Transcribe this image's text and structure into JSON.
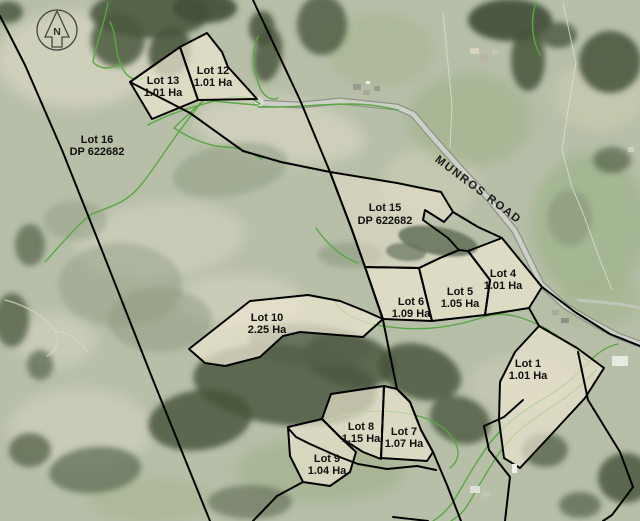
{
  "compass": {
    "label": "N"
  },
  "road": {
    "label": "MUNROS ROAD"
  },
  "lots": [
    {
      "name": "Lot 13",
      "sublabel": "1.01 Ha"
    },
    {
      "name": "Lot 12",
      "sublabel": "1.01 Ha"
    },
    {
      "name": "Lot 16",
      "sublabel": "DP 622682"
    },
    {
      "name": "Lot 15",
      "sublabel": "DP 622682"
    },
    {
      "name": "Lot 4",
      "sublabel": "1.01 Ha"
    },
    {
      "name": "Lot 5",
      "sublabel": "1.05 Ha"
    },
    {
      "name": "Lot 6",
      "sublabel": "1.09 Ha"
    },
    {
      "name": "Lot 1",
      "sublabel": "1.01 Ha"
    },
    {
      "name": "Lot 10",
      "sublabel": "2.25 Ha"
    },
    {
      "name": "Lot 8",
      "sublabel": "1.15 Ha"
    },
    {
      "name": "Lot 7",
      "sublabel": "1.07 Ha"
    },
    {
      "name": "Lot 9",
      "sublabel": "1.04 Ha"
    }
  ],
  "colors": {
    "boundary": "#000000",
    "green_line": "#58a843",
    "lot_fill": "#ebe4cf",
    "road_fill": "#cdd0c7",
    "road_casing": "#8e948a",
    "label_text": "#101010"
  }
}
